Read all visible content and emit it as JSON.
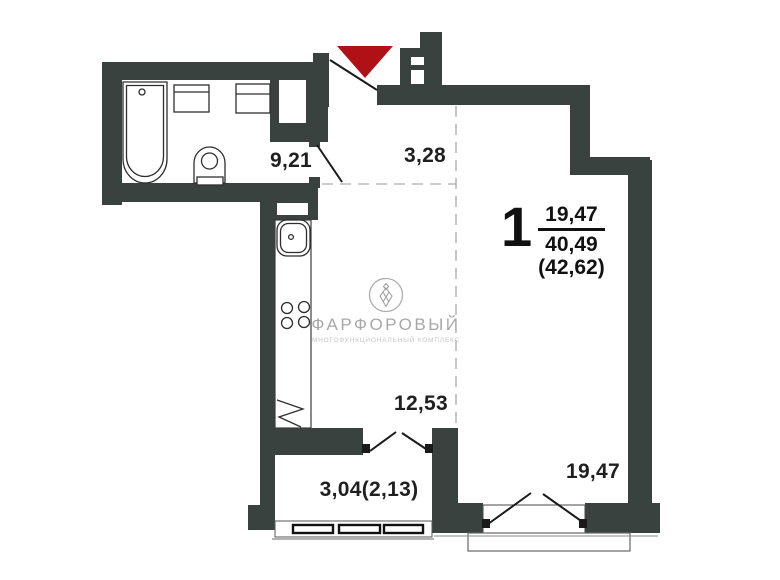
{
  "labels": {
    "hallway": "9,21",
    "corridor": "3,28",
    "kitchen_living": "12,53",
    "balcony": "3,04(2,13)",
    "room": "19,47"
  },
  "apartment_info": {
    "rooms_count": "1",
    "living_area": "19,47",
    "total_area": "40,49",
    "area_with_balcony": "(42,62)"
  },
  "logo": {
    "name": "ФАРФОРОВЫЙ",
    "tagline": "МНОГОФУНКЦИОНАЛЬНЫЙ КОМПЛЕКС"
  },
  "colors": {
    "wall": "#3a423f",
    "entrance_arrow": "#b01117",
    "dimension_text": "#1f1f1f",
    "logo_text": "#a8a8a8"
  }
}
